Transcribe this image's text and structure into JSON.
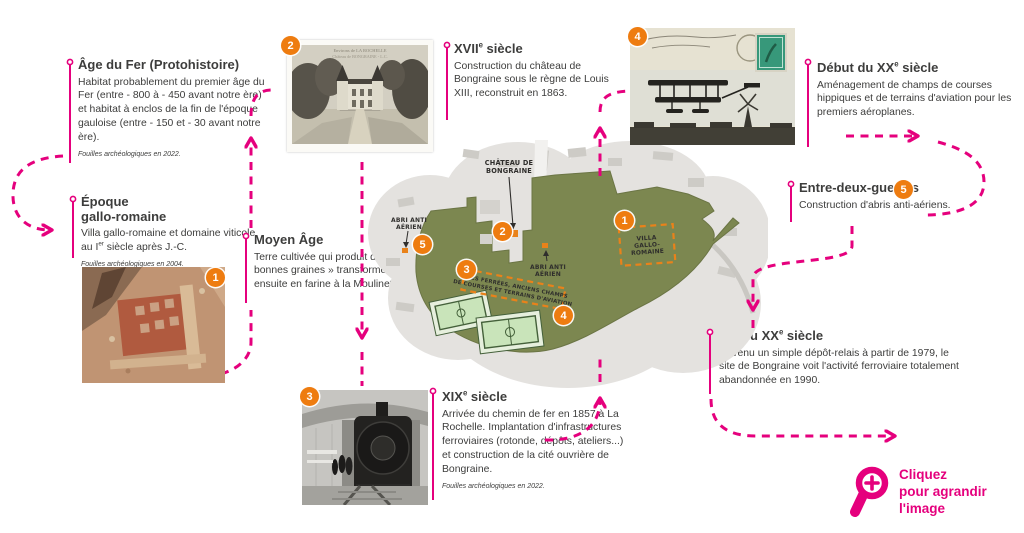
{
  "palette": {
    "pink": "#e5007d",
    "orange": "#ee7c10",
    "olive": "#7c8750",
    "text": "#3d3d3c"
  },
  "timeline": {
    "age_fer": {
      "title": "Âge du Fer (Protohistoire)",
      "body": "Habitat probablement du premier âge du Fer (entre - 800 à - 450 avant notre ère) et habitat à enclos de la fin de l'époque gauloise (entre - 150 et - 30 avant notre ère).",
      "footnote": "Fouilles archéologiques en 2022."
    },
    "epoque": {
      "title_line1": "Époque",
      "title_line2": "gallo-romaine",
      "body_pre": "Villa gallo-romaine et domaine viticole au I",
      "body_sup": "er",
      "body_post": " siècle après J.-C.",
      "footnote": "Fouilles archéologiques en 2004."
    },
    "moyen_age": {
      "title": "Moyen Âge",
      "body": "Terre cultivée qui produit de « bonnes graines » transformées ensuite en farine à la Moulinette."
    },
    "xvii": {
      "title_pre": "XVII",
      "title_sup": "e",
      "title_post": " siècle",
      "body": "Construction du château de Bongraine sous le règne de Louis XIII, reconstruit en 1863."
    },
    "xix": {
      "title_pre": "XIX",
      "title_sup": "e",
      "title_post": " siècle",
      "body": "Arrivée du chemin de fer en 1857 à La Rochelle. Implantation d'infrastructures ferroviaires (rotonde, dépôts, ateliers...) et construction de la cité ouvrière de Bongraine.",
      "footnote": "Fouilles archéologiques en 2022."
    },
    "debut_xx": {
      "title_pre": "Début du XX",
      "title_sup": "e",
      "title_post": " siècle",
      "body": "Aménagement de champs de courses hippiques et de terrains d'aviation pour les premiers aéroplanes."
    },
    "entre_deux": {
      "title": "Entre-deux-guerres",
      "body": "Construction d'abris anti-aériens."
    },
    "fin_xx": {
      "title_pre": "Fin du XX",
      "title_sup": "e",
      "title_post": " siècle",
      "body": "Devenu un simple dépôt-relais à partir de 1979, le site de Bongraine voit l'activité ferroviaire totalement abandonnée en 1990."
    }
  },
  "badges": {
    "n1": "1",
    "n2": "2",
    "n3": "3",
    "n4": "4",
    "n5": "5"
  },
  "map": {
    "labels": {
      "chateau_l1": "CHÂTEAU DE",
      "chateau_l2": "BONGRAINE",
      "abri_left_l1": "ABRI ANTI",
      "abri_left_l2": "AÉRIEN",
      "abri_center_l1": "ABRI ANTI",
      "abri_center_l2": "AÉRIEN",
      "villa_l1": "VILLA",
      "villa_l2": "GALLO-",
      "villa_l3": "ROMAINE",
      "voies_l1": "VOIES FERRÉES, ANCIENS CHAMPS",
      "voies_l2": "DE COURSES ET TERRAINS D'AVIATION"
    }
  },
  "photos": {
    "postcard_header_l1": "Environs de LA ROCHELLE",
    "postcard_header_l2": "Château de BONGRAINE - L.C."
  },
  "cta": {
    "line1": "Cliquez",
    "line2": "pour agrandir l'image"
  }
}
